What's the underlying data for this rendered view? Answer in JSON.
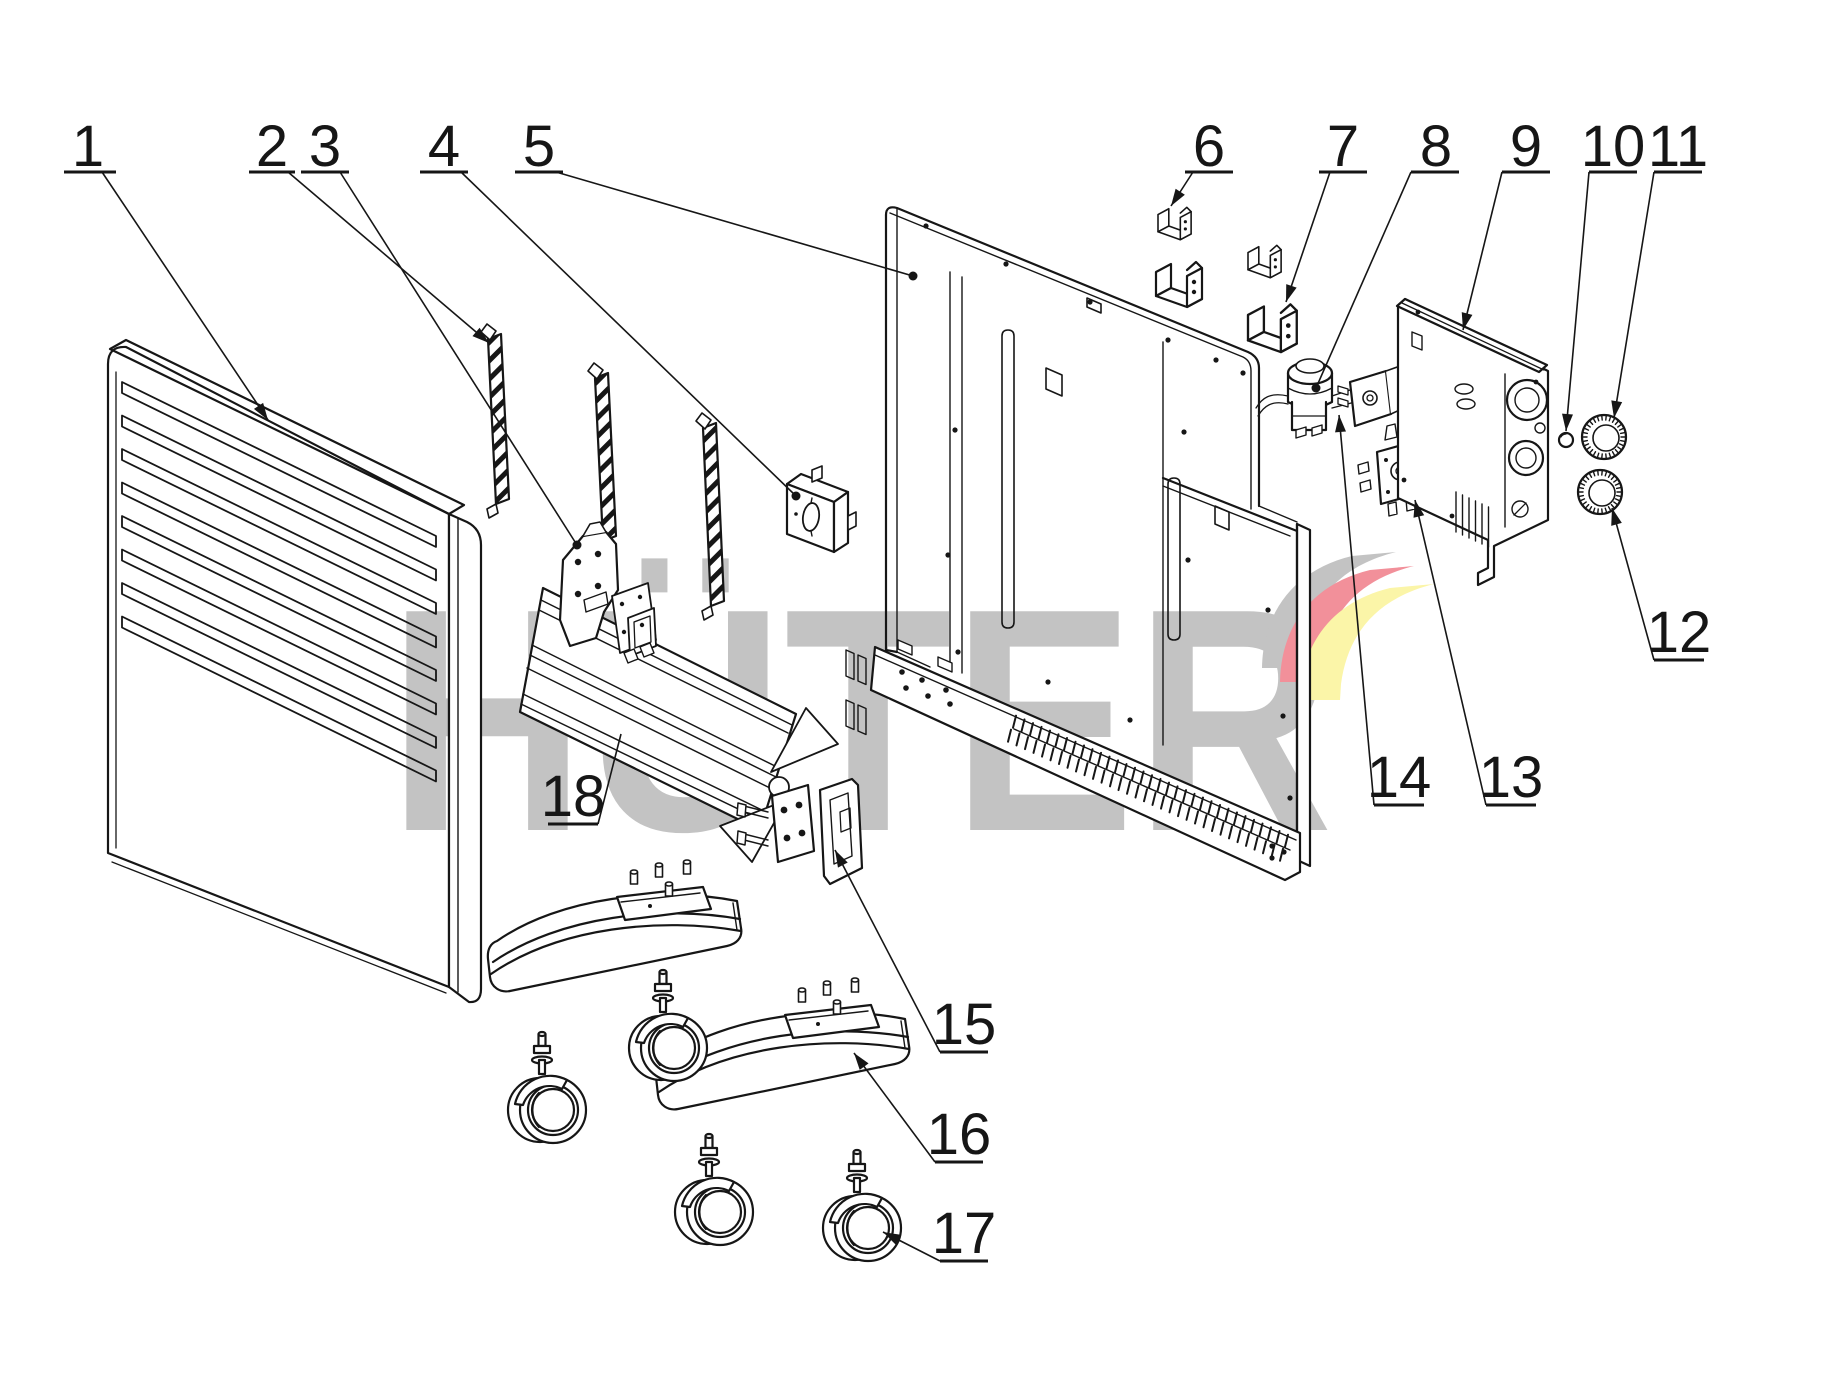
{
  "canvas": {
    "width": 1821,
    "height": 1381,
    "background": "#ffffff",
    "line_color": "#161616"
  },
  "watermark": {
    "text": "HÜTER",
    "color": "#c3c3c3",
    "logo_gray": "#c3c3c3",
    "logo_red": "#f2909a",
    "logo_yellow": "#fbf5a8"
  },
  "callouts": [
    {
      "n": "1",
      "tx": 88,
      "ty": 166,
      "ux1": 64,
      "ux2": 116,
      "uy": 172,
      "lx": 102,
      "ly": 172,
      "ex": 268,
      "ey": 420,
      "end": "arrow"
    },
    {
      "n": "2",
      "tx": 272,
      "ty": 166,
      "ux1": 249,
      "ux2": 295,
      "uy": 172,
      "lx": 288,
      "ly": 172,
      "ex": 489,
      "ey": 343,
      "end": "arrow"
    },
    {
      "n": "3",
      "tx": 325,
      "ty": 166,
      "ux1": 301,
      "ux2": 349,
      "uy": 172,
      "lx": 340,
      "ly": 172,
      "ex": 577,
      "ey": 545,
      "end": "dot"
    },
    {
      "n": "4",
      "tx": 444,
      "ty": 166,
      "ux1": 420,
      "ux2": 468,
      "uy": 172,
      "lx": 461,
      "ly": 172,
      "ex": 796,
      "ey": 496,
      "end": "dot"
    },
    {
      "n": "5",
      "tx": 539,
      "ty": 166,
      "ux1": 515,
      "ux2": 563,
      "uy": 172,
      "lx": 556,
      "ly": 172,
      "ex": 913,
      "ey": 276,
      "end": "dot"
    },
    {
      "n": "6",
      "tx": 1209,
      "ty": 166,
      "ux1": 1185,
      "ux2": 1233,
      "uy": 172,
      "lx": 1193,
      "ly": 172,
      "ex": 1171,
      "ey": 206,
      "end": "arrow"
    },
    {
      "n": "7",
      "tx": 1343,
      "ty": 166,
      "ux1": 1319,
      "ux2": 1367,
      "uy": 172,
      "lx": 1330,
      "ly": 172,
      "ex": 1286,
      "ey": 302,
      "end": "arrow"
    },
    {
      "n": "8",
      "tx": 1436,
      "ty": 166,
      "ux1": 1411,
      "ux2": 1459,
      "uy": 172,
      "lx": 1411,
      "ly": 172,
      "ex": 1316,
      "ey": 388,
      "end": "dot"
    },
    {
      "n": "9",
      "tx": 1526,
      "ty": 166,
      "ux1": 1502,
      "ux2": 1550,
      "uy": 172,
      "lx": 1502,
      "ly": 172,
      "ex": 1463,
      "ey": 330,
      "end": "arrow"
    },
    {
      "n": "10",
      "tx": 1613,
      "ty": 166,
      "ux1": 1589,
      "ux2": 1637,
      "uy": 172,
      "lx": 1589,
      "ly": 172,
      "ex": 1566,
      "ey": 431,
      "end": "arrow"
    },
    {
      "n": "11",
      "tx": 1678,
      "ty": 166,
      "ux1": 1654,
      "ux2": 1702,
      "uy": 172,
      "lx": 1654,
      "ly": 172,
      "ex": 1614,
      "ey": 418,
      "end": "arrow"
    },
    {
      "n": "12",
      "tx": 1679,
      "ty": 652,
      "ux1": 1654,
      "ux2": 1704,
      "uy": 660,
      "lx": 1654,
      "ly": 660,
      "ex": 1612,
      "ey": 508,
      "end": "arrow"
    },
    {
      "n": "13",
      "tx": 1511,
      "ty": 797,
      "ux1": 1486,
      "ux2": 1536,
      "uy": 805,
      "lx": 1486,
      "ly": 805,
      "ex": 1415,
      "ey": 500,
      "end": "arrow"
    },
    {
      "n": "14",
      "tx": 1399,
      "ty": 797,
      "ux1": 1374,
      "ux2": 1424,
      "uy": 805,
      "lx": 1374,
      "ly": 805,
      "ex": 1339,
      "ey": 415,
      "end": "arrow"
    },
    {
      "n": "15",
      "tx": 964,
      "ty": 1044,
      "ux1": 940,
      "ux2": 988,
      "uy": 1052,
      "lx": 940,
      "ly": 1052,
      "ex": 835,
      "ey": 850,
      "end": "arrow"
    },
    {
      "n": "16",
      "tx": 959,
      "ty": 1154,
      "ux1": 935,
      "ux2": 983,
      "uy": 1162,
      "lx": 935,
      "ly": 1162,
      "ex": 854,
      "ey": 1053,
      "end": "arrow"
    },
    {
      "n": "17",
      "tx": 964,
      "ty": 1253,
      "ux1": 940,
      "ux2": 988,
      "uy": 1261,
      "lx": 940,
      "ly": 1261,
      "ex": 883,
      "ey": 1232,
      "end": "arrow"
    },
    {
      "n": "18",
      "tx": 573,
      "ty": 816,
      "ux1": 548,
      "ux2": 598,
      "uy": 824,
      "lx": 598,
      "ly": 824,
      "ex": 621,
      "ey": 734,
      "end": "none"
    }
  ]
}
